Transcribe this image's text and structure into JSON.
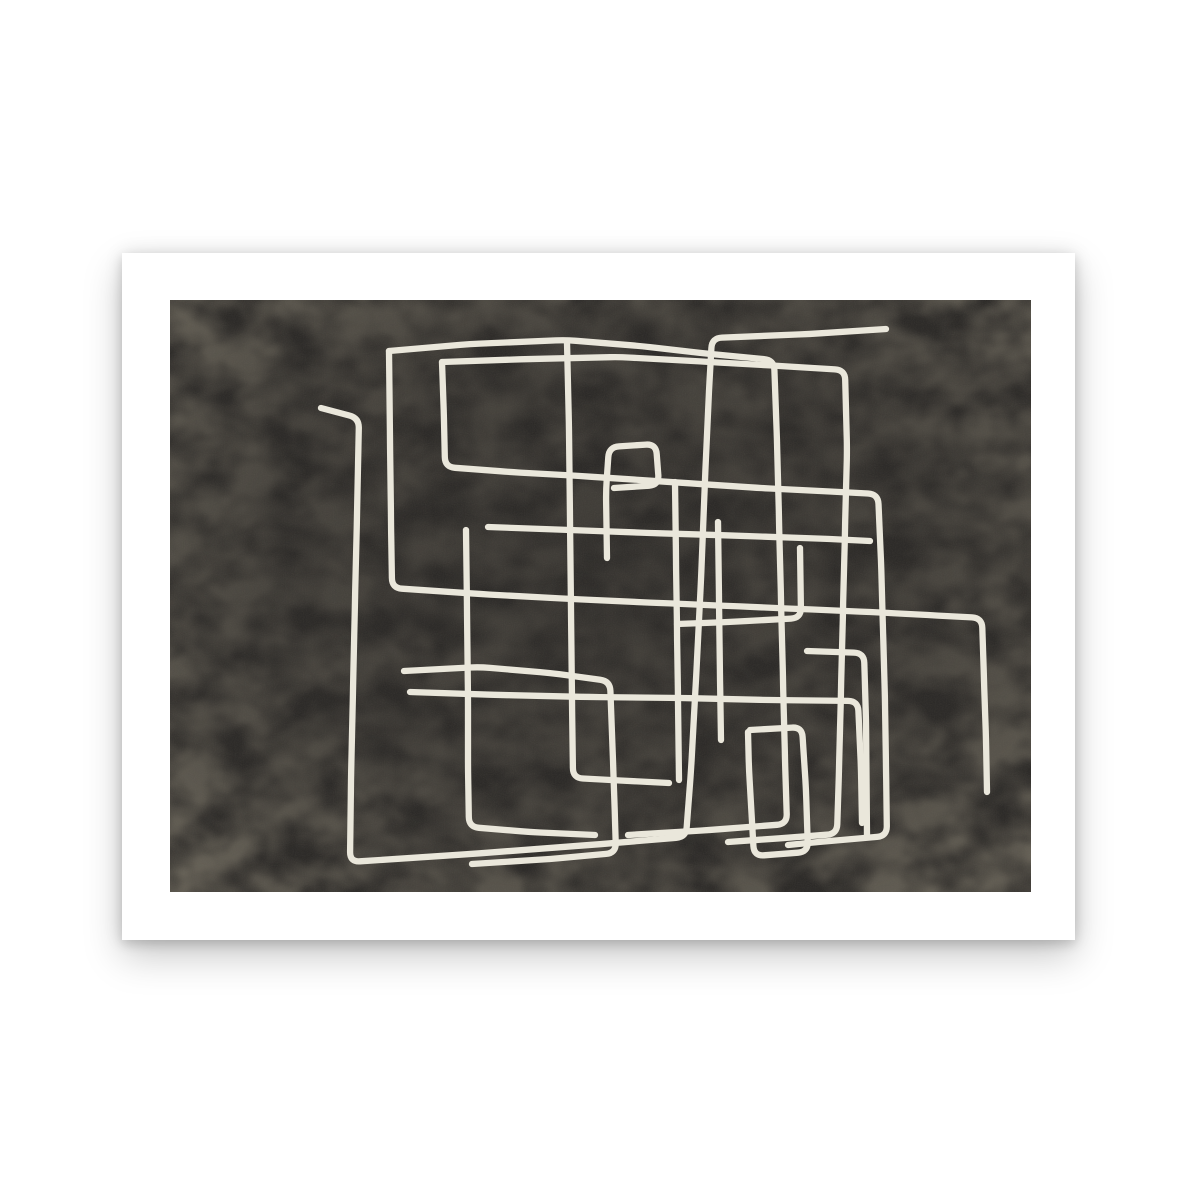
{
  "page": {
    "background_color": "#ffffff"
  },
  "poster": {
    "sheet_color": "#ffffff",
    "shadow_color": "rgba(0,0,0,0.22)",
    "content": "abstract single-line maze art print, landscape orientation, white margin border"
  },
  "artwork": {
    "style": "continuous-line abstract maze drawing",
    "background_color": "#2c2a28",
    "texture_blotch_color": "#97907f",
    "texture_grain_color": "#888276",
    "line_color": "#eae7db",
    "line_width": 6.3,
    "corner_radius": 10,
    "canvas_width": 861,
    "canvas_height": 592,
    "strokes": [
      [
        [
          151,
          108
        ],
        [
          189,
          118
        ],
        [
          187,
          215
        ],
        [
          185,
          300
        ],
        [
          183,
          390
        ],
        [
          181,
          480
        ],
        [
          180,
          562
        ],
        [
          300,
          554
        ],
        [
          420,
          545
        ],
        [
          516,
          537
        ],
        [
          521,
          470
        ],
        [
          526,
          380
        ],
        [
          531,
          280
        ],
        [
          535,
          180
        ],
        [
          539,
          90
        ],
        [
          542,
          38
        ],
        [
          640,
          34
        ],
        [
          716,
          29
        ]
      ],
      [
        [
          219,
          51
        ],
        [
          300,
          44
        ],
        [
          396,
          40
        ],
        [
          470,
          46
        ],
        [
          540,
          54
        ],
        [
          604,
          60
        ],
        [
          607,
          140
        ],
        [
          609,
          220
        ],
        [
          611,
          300
        ],
        [
          613,
          380
        ],
        [
          615,
          460
        ],
        [
          617,
          524
        ],
        [
          540,
          530
        ],
        [
          458,
          535
        ]
      ],
      [
        [
          219,
          51
        ],
        [
          220,
          140
        ],
        [
          221,
          220
        ],
        [
          222,
          288
        ],
        [
          310,
          294
        ],
        [
          400,
          299
        ],
        [
          490,
          303
        ],
        [
          560,
          306
        ],
        [
          630,
          309
        ],
        [
          700,
          312
        ],
        [
          758,
          315
        ],
        [
          812,
          318
        ],
        [
          814,
          380
        ],
        [
          816,
          440
        ],
        [
          817,
          492
        ]
      ],
      [
        [
          272,
          62
        ],
        [
          360,
          59
        ],
        [
          450,
          57
        ],
        [
          540,
          62
        ],
        [
          610,
          66
        ],
        [
          675,
          70
        ],
        [
          677,
          150
        ],
        [
          675,
          230
        ],
        [
          673,
          310
        ],
        [
          671,
          390
        ],
        [
          669,
          470
        ],
        [
          667,
          534
        ],
        [
          600,
          539
        ],
        [
          558,
          542
        ]
      ],
      [
        [
          272,
          62
        ],
        [
          274,
          120
        ],
        [
          275,
          167
        ],
        [
          340,
          172
        ],
        [
          410,
          176
        ],
        [
          470,
          180
        ],
        [
          530,
          184
        ],
        [
          590,
          188
        ],
        [
          650,
          191
        ],
        [
          708,
          194
        ],
        [
          711,
          260
        ],
        [
          713,
          330
        ],
        [
          715,
          400
        ],
        [
          716,
          470
        ],
        [
          717,
          536
        ],
        [
          660,
          541
        ],
        [
          618,
          545
        ]
      ],
      [
        [
          397,
          42
        ],
        [
          399,
          130
        ],
        [
          400,
          220
        ],
        [
          401,
          310
        ],
        [
          402,
          400
        ],
        [
          403,
          478
        ],
        [
          460,
          481
        ],
        [
          499,
          483
        ]
      ],
      [
        [
          437,
          258
        ],
        [
          436,
          190
        ],
        [
          439,
          147
        ],
        [
          486,
          144
        ],
        [
          489,
          185
        ],
        [
          444,
          188
        ]
      ],
      [
        [
          318,
          227
        ],
        [
          400,
          230
        ],
        [
          480,
          233
        ],
        [
          545,
          235
        ],
        [
          605,
          237
        ],
        [
          660,
          239
        ],
        [
          700,
          241
        ]
      ],
      [
        [
          234,
          371
        ],
        [
          310,
          367
        ],
        [
          380,
          373
        ],
        [
          440,
          381
        ],
        [
          443,
          460
        ],
        [
          445,
          520
        ],
        [
          446,
          553
        ],
        [
          380,
          559
        ],
        [
          302,
          564
        ]
      ],
      [
        [
          580,
          430
        ],
        [
          632,
          427
        ],
        [
          636,
          490
        ],
        [
          638,
          552
        ],
        [
          584,
          556
        ],
        [
          579,
          470
        ],
        [
          578,
          432
        ]
      ],
      [
        [
          637,
          351
        ],
        [
          694,
          353
        ],
        [
          696,
          420
        ],
        [
          697,
          535
        ]
      ],
      [
        [
          240,
          392
        ],
        [
          330,
          395
        ],
        [
          420,
          397
        ],
        [
          510,
          398
        ],
        [
          600,
          400
        ],
        [
          688,
          401
        ],
        [
          691,
          470
        ],
        [
          692,
          523
        ]
      ],
      [
        [
          296,
          230
        ],
        [
          297,
          310
        ],
        [
          298,
          400
        ],
        [
          298,
          470
        ],
        [
          299,
          527
        ],
        [
          360,
          532
        ],
        [
          425,
          535
        ]
      ],
      [
        [
          630,
          248
        ],
        [
          631,
          318
        ],
        [
          560,
          322
        ],
        [
          507,
          324
        ]
      ],
      [
        [
          505,
          182
        ],
        [
          506,
          260
        ],
        [
          507,
          330
        ],
        [
          508,
          400
        ],
        [
          509,
          480
        ]
      ],
      [
        [
          548,
          222
        ],
        [
          549,
          300
        ],
        [
          550,
          380
        ],
        [
          551,
          440
        ]
      ]
    ]
  }
}
